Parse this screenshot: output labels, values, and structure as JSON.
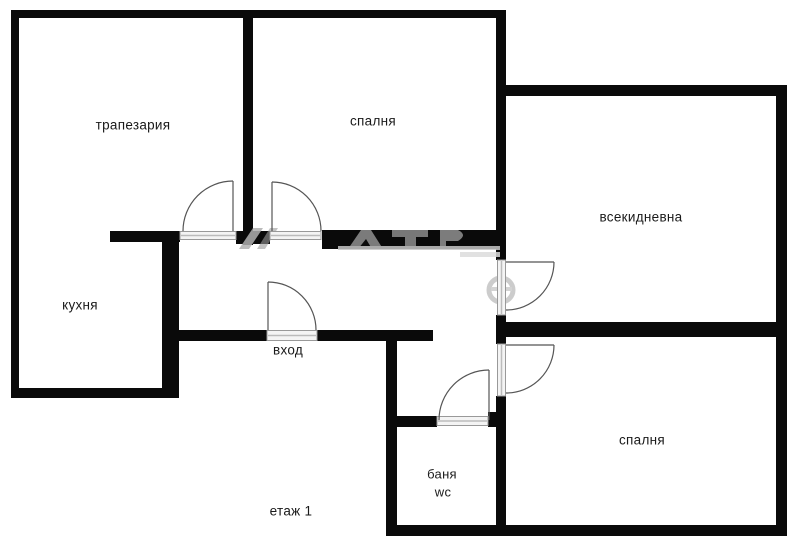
{
  "floor_plan": {
    "rooms": {
      "dining": "трапезария",
      "bedroom_top": "спалня",
      "living_room": "всекидневна",
      "kitchen": "кухня",
      "entrance": "вход",
      "bathroom": "баня",
      "wc": "wc",
      "bedroom_bottom": "спалня"
    },
    "floor_label": "етаж 1",
    "colors": {
      "background": "#ffffff",
      "wall": "#0a0a0a",
      "door_line": "#555555",
      "threshold_fill": "#f4f4f4",
      "threshold_edge": "#999999",
      "watermark": "#9e9e9e",
      "text": "#1a1a1a"
    }
  }
}
